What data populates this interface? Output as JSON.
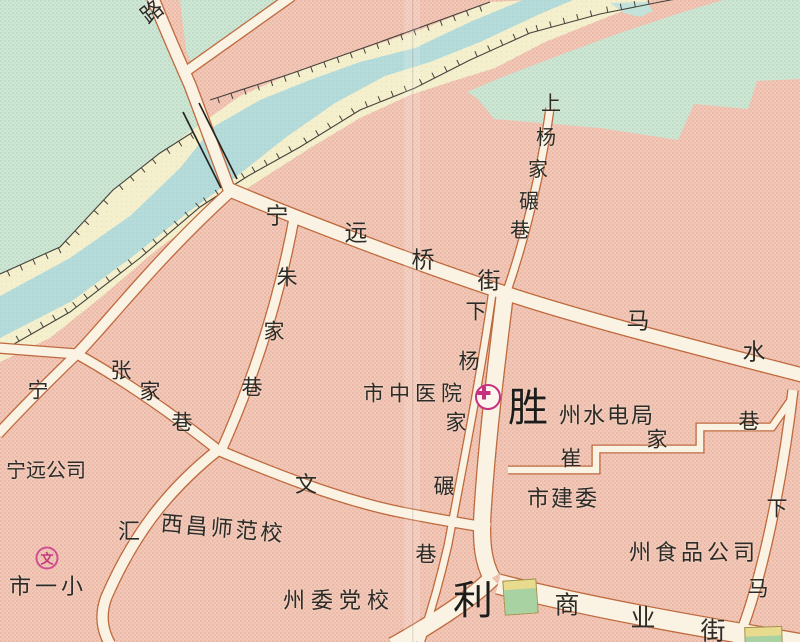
{
  "map": {
    "region_note": "city street map section",
    "colors": {
      "block_pink": "#f2c9b9",
      "water_blue": "#b5dcdb",
      "land_green": "#cfe7d5",
      "bank_yellow": "#f4efcd",
      "street_fill": "#faf2e3",
      "street_casing": "#bf6a3e",
      "label_ink": "#2d2b27",
      "poi_magenta": "#c5317f"
    },
    "streets": {
      "lu": "路",
      "shang_yangjianian": "上杨家碾巷",
      "ningyuan_qiao_jie": "宁远桥街",
      "zhujia_xiang": "朱家巷",
      "zhangjia_xiang": "张家巷",
      "ning": "宁",
      "xia_yangjianian": "下杨家碾巷",
      "mashui_xiang": "马水",
      "cuijia_xiang": "崔家巷",
      "shengli": "胜利",
      "wenhui": "文汇",
      "shangye_jie": "商业街",
      "xia": "下",
      "ma": "马"
    },
    "pois": {
      "hospital": "市中医院",
      "water_power_bureau": "州水电局",
      "construction_committee": "市建委",
      "food_company": "州食品公司",
      "ningyuan_company": "宁远公司",
      "normal_school": "西昌师范校",
      "party_school": "州委党校",
      "first_primary_school": "市一小"
    },
    "icons": {
      "hospital": "hospital-cross-icon",
      "school": "school-wen-icon",
      "school_glyph": "文"
    }
  }
}
